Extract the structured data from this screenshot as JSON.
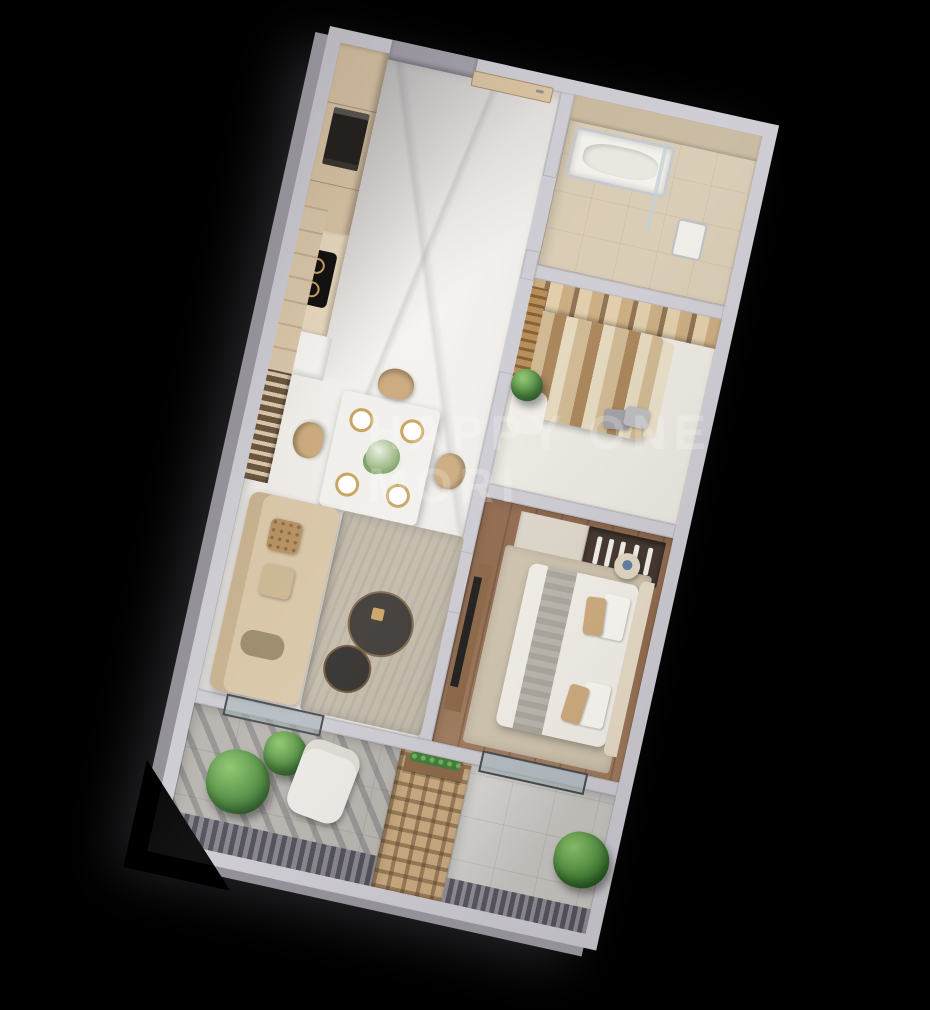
{
  "watermark": {
    "line1": "HAPPY ONE",
    "line2": "MORI",
    "color": "#ffffff",
    "opacity": 0.21
  },
  "scene": {
    "background": "#000000",
    "view": "3d-isometric-apartment-floor-plan",
    "rotation_deg": 12.5
  },
  "palette": {
    "wall_top": "#cdcbd2",
    "wall_side": "#949199",
    "marble_floor": "#ece9e5",
    "wood_floor": "#8f674a",
    "cabinet_beige": "#d7c2a4",
    "bed_linen": "#f3efe8",
    "accent_gold": "#c9a35f",
    "plant_green": "#4c8a3c",
    "tile_beige": "#d8cab2",
    "balcony_stone": "#b6b3ae",
    "sofa_beige": "#d8c5a6"
  },
  "rooms": [
    {
      "id": "kitchen"
    },
    {
      "id": "entry-hall"
    },
    {
      "id": "bathroom"
    },
    {
      "id": "bedroom-1"
    },
    {
      "id": "bedroom-2"
    },
    {
      "id": "living-dining"
    },
    {
      "id": "balcony-left"
    },
    {
      "id": "balcony-right"
    }
  ]
}
